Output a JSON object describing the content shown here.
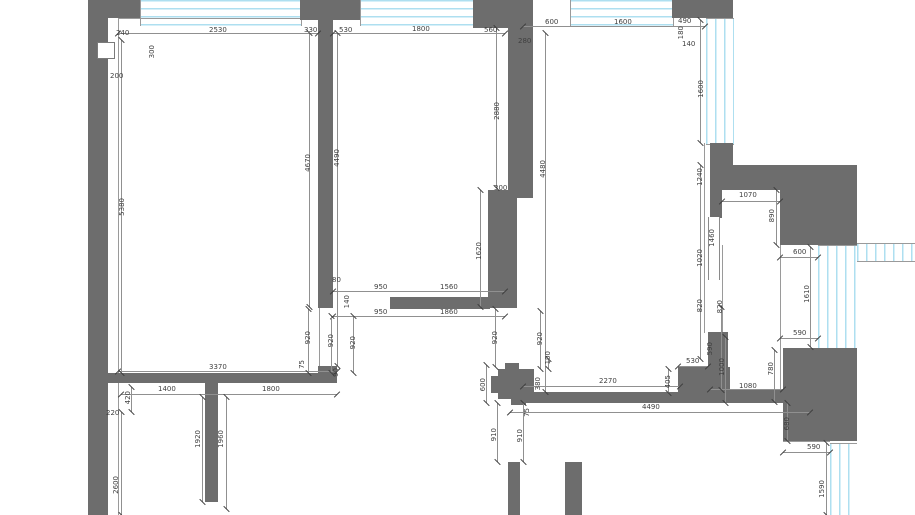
{
  "drawing": {
    "type": "architectural-floor-plan",
    "units": "mm",
    "palette": {
      "wall_fill": "#6d6d6d",
      "window_line": "#aedff0",
      "dimension_line": "#909090",
      "dimension_text": "#3f3f3f",
      "background": "#ffffff"
    },
    "dims": [
      {
        "v": "240",
        "x": 122,
        "y": 33
      },
      {
        "v": "2530",
        "x": 217,
        "y": 30
      },
      {
        "v": "330",
        "x": 310,
        "y": 30
      },
      {
        "v": "530",
        "x": 345,
        "y": 30
      },
      {
        "v": "1800",
        "x": 420,
        "y": 29
      },
      {
        "v": "560",
        "x": 490,
        "y": 30
      },
      {
        "v": "280",
        "x": 524,
        "y": 41
      },
      {
        "v": "600",
        "x": 551,
        "y": 22
      },
      {
        "v": "1600",
        "x": 622,
        "y": 22
      },
      {
        "v": "490",
        "x": 684,
        "y": 21
      },
      {
        "v": "180",
        "x": 681,
        "y": 32,
        "r": 90
      },
      {
        "v": "140",
        "x": 688,
        "y": 44
      },
      {
        "v": "300",
        "x": 152,
        "y": 51,
        "r": 90
      },
      {
        "v": "200",
        "x": 116,
        "y": 76
      },
      {
        "v": "5380",
        "x": 122,
        "y": 206,
        "r": 90
      },
      {
        "v": "4670",
        "x": 308,
        "y": 162,
        "r": 90
      },
      {
        "v": "4490",
        "x": 337,
        "y": 157,
        "r": 90
      },
      {
        "v": "2880",
        "x": 497,
        "y": 110,
        "r": 90
      },
      {
        "v": "4480",
        "x": 543,
        "y": 168,
        "r": 90
      },
      {
        "v": "1600",
        "x": 701,
        "y": 88,
        "r": 90
      },
      {
        "v": "1620",
        "x": 479,
        "y": 250,
        "r": 90
      },
      {
        "v": "300",
        "x": 500,
        "y": 188
      },
      {
        "v": "1240",
        "x": 700,
        "y": 176,
        "r": 90
      },
      {
        "v": "1070",
        "x": 747,
        "y": 195
      },
      {
        "v": "890",
        "x": 772,
        "y": 215,
        "r": 90
      },
      {
        "v": "1460",
        "x": 712,
        "y": 237,
        "r": 90
      },
      {
        "v": "1020",
        "x": 700,
        "y": 257,
        "r": 90
      },
      {
        "v": "600",
        "x": 799,
        "y": 252
      },
      {
        "v": "1610",
        "x": 807,
        "y": 293,
        "r": 90
      },
      {
        "v": "820",
        "x": 700,
        "y": 305,
        "r": 90
      },
      {
        "v": "820",
        "x": 720,
        "y": 306,
        "r": 90
      },
      {
        "v": "590",
        "x": 799,
        "y": 333
      },
      {
        "v": "80",
        "x": 336,
        "y": 280
      },
      {
        "v": "140",
        "x": 347,
        "y": 301,
        "r": 90
      },
      {
        "v": "950",
        "x": 380,
        "y": 287
      },
      {
        "v": "1560",
        "x": 448,
        "y": 287
      },
      {
        "v": "950",
        "x": 380,
        "y": 312
      },
      {
        "v": "1860",
        "x": 448,
        "y": 312
      },
      {
        "v": "920",
        "x": 308,
        "y": 337,
        "r": 90
      },
      {
        "v": "920",
        "x": 331,
        "y": 340,
        "r": 90
      },
      {
        "v": "920",
        "x": 353,
        "y": 342,
        "r": 90
      },
      {
        "v": "920",
        "x": 495,
        "y": 337,
        "r": 90
      },
      {
        "v": "920",
        "x": 540,
        "y": 338,
        "r": 90
      },
      {
        "v": "100",
        "x": 548,
        "y": 357,
        "r": 90
      },
      {
        "v": "3370",
        "x": 217,
        "y": 367
      },
      {
        "v": "75",
        "x": 302,
        "y": 364,
        "r": 90
      },
      {
        "v": "90",
        "x": 336,
        "y": 372,
        "r": 90
      },
      {
        "v": "1400",
        "x": 166,
        "y": 389
      },
      {
        "v": "1800",
        "x": 270,
        "y": 389
      },
      {
        "v": "420",
        "x": 128,
        "y": 397,
        "r": 90
      },
      {
        "v": "220",
        "x": 112,
        "y": 413
      },
      {
        "v": "1920",
        "x": 198,
        "y": 438,
        "r": 90
      },
      {
        "v": "1960",
        "x": 221,
        "y": 438,
        "r": 90
      },
      {
        "v": "2600",
        "x": 116,
        "y": 484,
        "r": 90
      },
      {
        "v": "600",
        "x": 483,
        "y": 384,
        "r": 90
      },
      {
        "v": "380",
        "x": 538,
        "y": 383,
        "r": 90
      },
      {
        "v": "75",
        "x": 527,
        "y": 412,
        "r": 90
      },
      {
        "v": "910",
        "x": 494,
        "y": 434,
        "r": 90
      },
      {
        "v": "910",
        "x": 520,
        "y": 435,
        "r": 90
      },
      {
        "v": "2270",
        "x": 607,
        "y": 381
      },
      {
        "v": "405",
        "x": 668,
        "y": 381,
        "r": 90
      },
      {
        "v": "530",
        "x": 692,
        "y": 361
      },
      {
        "v": "590",
        "x": 710,
        "y": 348,
        "r": 90
      },
      {
        "v": "1000",
        "x": 722,
        "y": 366,
        "r": 90
      },
      {
        "v": "4490",
        "x": 650,
        "y": 407
      },
      {
        "v": "1080",
        "x": 747,
        "y": 386
      },
      {
        "v": "780",
        "x": 771,
        "y": 368,
        "r": 90
      },
      {
        "v": "680",
        "x": 787,
        "y": 423,
        "r": 90
      },
      {
        "v": "590",
        "x": 813,
        "y": 447
      },
      {
        "v": "1590",
        "x": 822,
        "y": 488,
        "r": 90
      }
    ]
  }
}
